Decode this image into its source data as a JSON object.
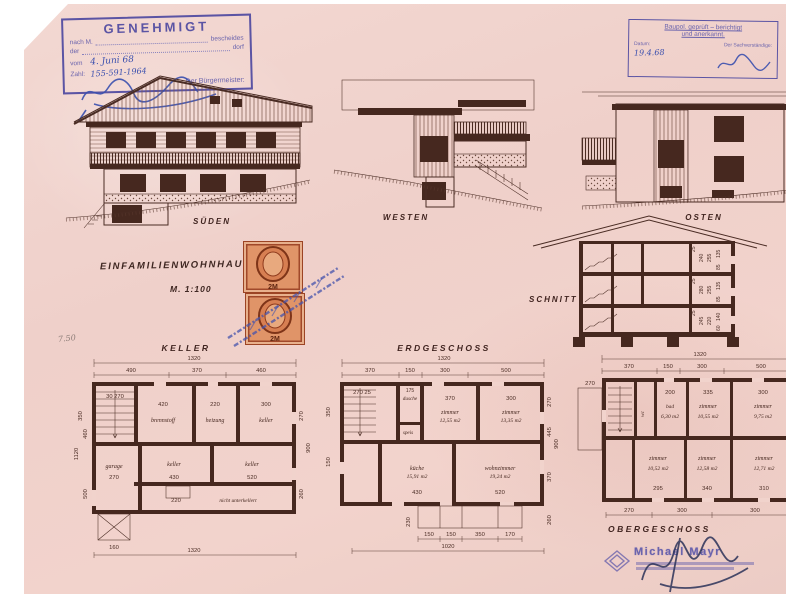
{
  "stamps": {
    "genehmigt": {
      "title": "GENEHMIGT",
      "line1_label": "nach M.",
      "line1_tail": "bescheides",
      "line2_label": "der",
      "line2_tail": "dorf",
      "vom_label": "vom",
      "vom_value": "4. Juni 68",
      "zahl_label": "Zahl:",
      "zahl_value": "155-591-1964",
      "signer_label": "Der Bürgermeister:"
    },
    "baupol": {
      "line1": "Baupol. geprüft – berichtigt",
      "line2": "und anerkannt.",
      "datum_label": "Datum:",
      "expert_label": "Der Sachverständige:",
      "datum_value": "19.4.68"
    },
    "revenue": {
      "value": "2M"
    },
    "architect": {
      "name": "Michael Mayr"
    }
  },
  "titles": {
    "project": "EINFAMILIENWOHNHAUS",
    "scale": "M. 1:100",
    "pencil_note": "7.50"
  },
  "views": {
    "south": "SÜDEN",
    "west": "WESTEN",
    "east": "OSTEN",
    "section": "SCHNITT"
  },
  "section": {
    "floors": [
      [
        "25",
        "240",
        "255",
        "135",
        "85"
      ],
      [
        "25",
        "280",
        "255",
        "135",
        "85"
      ],
      [
        "25",
        "245",
        "220",
        "140",
        "60"
      ]
    ]
  },
  "plans": {
    "keller": {
      "title": "KELLER",
      "dim_total": "1320",
      "dims_top": [
        "490",
        "370",
        "460"
      ],
      "rooms": [
        "brennstoff",
        "heizung",
        "keller",
        "garage",
        "keller",
        "keller",
        "nicht unterkellert"
      ],
      "dims_room": [
        "420",
        "220",
        "300",
        "270",
        "430",
        "520",
        "220"
      ],
      "stair_dim": "30  270",
      "dims_left": [
        "350",
        "1120",
        "500",
        "460"
      ],
      "dims_right": [
        "270",
        "900",
        "260"
      ],
      "dims_bottom": [
        "160",
        "1320"
      ]
    },
    "erdgeschoss": {
      "title": "ERDGESCHOSS",
      "dim_total": "1320",
      "dims_top": [
        "370",
        "150",
        "300",
        "500"
      ],
      "entry_dims": "270  25",
      "rooms": [
        {
          "name": "dusche",
          "area": ""
        },
        {
          "name": "zimmer",
          "area": "12,55 m2"
        },
        {
          "name": "zimmer",
          "area": "13,35 m2"
        },
        {
          "name": "speis",
          "area": ""
        },
        {
          "name": "küche",
          "area": "15,91 m2"
        },
        {
          "name": "wohnzimmer",
          "area": "19,24 m2"
        }
      ],
      "dims_room": [
        "175",
        "370",
        "300",
        "430",
        "520"
      ],
      "dims_left": [
        "350",
        "150",
        "230"
      ],
      "dims_right": [
        "270",
        "445",
        "370",
        "900",
        "260"
      ],
      "dims_bottom": [
        "150",
        "150",
        "350",
        "170"
      ],
      "dim_bottom_total": "1020"
    },
    "obergeschoss": {
      "title": "OBERGESCHOSS",
      "dim_total": "1320",
      "dims_top": [
        "370",
        "150",
        "300",
        "500"
      ],
      "balcony_dim": "270",
      "rooms": [
        {
          "name": "wc",
          "area": ""
        },
        {
          "name": "bad",
          "area": "6,30 m2"
        },
        {
          "name": "zimmer",
          "area": "10,55 m2"
        },
        {
          "name": "zimmer",
          "area": "9,75 m2"
        },
        {
          "name": "zimmer",
          "area": "10,52 m2"
        },
        {
          "name": "zimmer",
          "area": "12,58 m2"
        },
        {
          "name": "zimmer",
          "area": "12,71 m2"
        }
      ],
      "dims_room": [
        "200",
        "335",
        "300",
        "295",
        "340",
        "310"
      ],
      "dims_right": [
        "270",
        "440"
      ],
      "dims_bottom": [
        "270",
        "300",
        "300"
      ]
    }
  },
  "colors": {
    "paper": "#f1d3cc",
    "ink": "#4a2c24",
    "stamp_purple": "#5b54a4",
    "hand_blue": "#3a4fae",
    "stamp_orange": "#e09468"
  }
}
